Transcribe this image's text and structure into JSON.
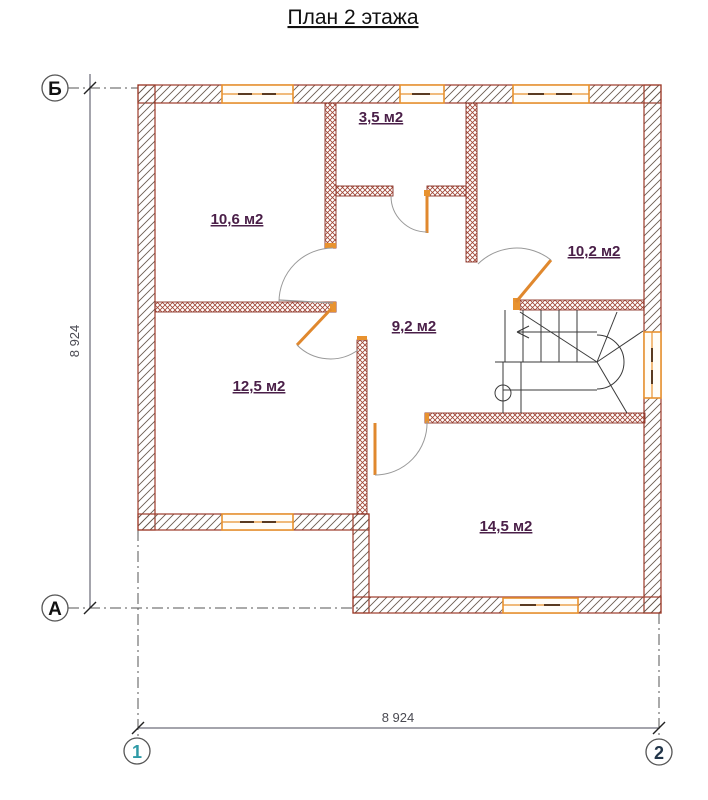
{
  "title": "План 2 этажа",
  "rooms": [
    {
      "label": "10,6 м2"
    },
    {
      "label": "3,5 м2"
    },
    {
      "label": "10,2 м2"
    },
    {
      "label": "9,2 м2"
    },
    {
      "label": "12,5 м2"
    },
    {
      "label": "14,5 м2"
    }
  ],
  "dimensions": {
    "left_vertical": "8 924",
    "bottom_horizontal": "8 924"
  },
  "axis_markers": {
    "row_top": "Б",
    "row_bottom": "А",
    "col_left": "1",
    "col_right": "2"
  },
  "colors": {
    "wall_outline": "#9c3a28",
    "hatch": "#6a5c50",
    "partition_hatch": "#a04434",
    "joinery_orange": "#e8922f",
    "room_label": "#4a1f48",
    "marker_1": "#2e9aa6",
    "marker_2": "#223549",
    "title": "#111111"
  }
}
